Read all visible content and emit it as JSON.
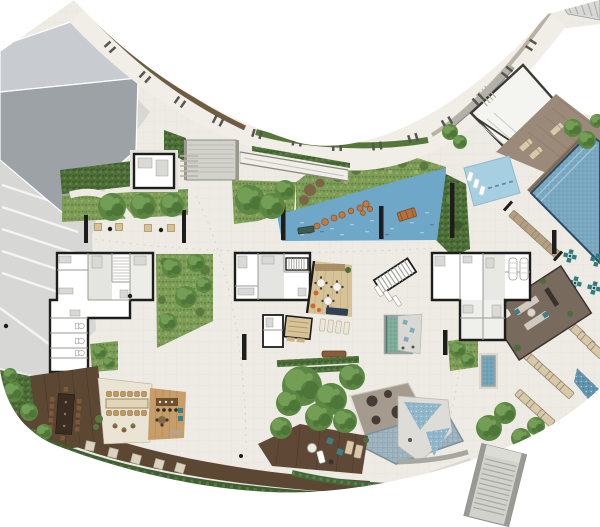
{
  "view": {
    "width": 600,
    "height": 527,
    "background": "#ffffff"
  },
  "plan": {
    "kind-icon": "site-plan-icon",
    "areas": [
      {
        "id": "garage-roof",
        "color_key": "roofMid"
      },
      {
        "id": "parking-court",
        "color_key": "parking"
      },
      {
        "id": "curved-walkway",
        "color_key": "walkway"
      },
      {
        "id": "walkway-hedge-brown",
        "color_key": "hedgeBrown"
      },
      {
        "id": "walkway-hedge-green",
        "color_key": "hedgeGreen"
      },
      {
        "id": "central-lagoon-pond",
        "color_key": "pondBlue"
      },
      {
        "id": "stepping-stones",
        "color_key": "stoneOrange"
      },
      {
        "id": "kids-pool",
        "color_key": "kidsPool"
      },
      {
        "id": "main-pool",
        "color_key": "poolBlue"
      },
      {
        "id": "pool-terrace",
        "color_key": "terrace"
      },
      {
        "id": "northeast-pavilion",
        "color_key": "roofLight"
      },
      {
        "id": "unit-plans-left",
        "color_key": "wall"
      },
      {
        "id": "unit-plans-center",
        "color_key": "wall"
      },
      {
        "id": "unit-plans-right",
        "color_key": "wall"
      },
      {
        "id": "lobby-wood-floor",
        "color_key": "woodFloor"
      },
      {
        "id": "plunge-pool-center",
        "color_key": "plungeGreen"
      },
      {
        "id": "plunge-pool-right",
        "color_key": "plungeBlue"
      },
      {
        "id": "sauna",
        "color_key": "woodFloor"
      },
      {
        "id": "east-lounge-room",
        "color_key": "loungeFloor"
      },
      {
        "id": "mosaic-crosses",
        "color_key": "mosaicTeal"
      },
      {
        "id": "sun-loungers",
        "color_key": "loungerTan"
      },
      {
        "id": "water-channel",
        "color_key": "channelBlue"
      },
      {
        "id": "southwest-wood-deck",
        "color_key": "deckDark"
      },
      {
        "id": "party-room-table",
        "color_key": "chairWood"
      },
      {
        "id": "bar-wood-floor",
        "color_key": "woodMid"
      },
      {
        "id": "south-brown-deck",
        "color_key": "deckBrown"
      },
      {
        "id": "south-taupe-deck",
        "color_key": "deckTaupe"
      },
      {
        "id": "splash-pad",
        "color_key": "splashBlue"
      },
      {
        "id": "south-east-stairs",
        "color_key": "stairGray"
      },
      {
        "id": "gardens-and-trees",
        "color_key": "gardenBase"
      }
    ]
  },
  "palette": {
    "paving": "#edebe3",
    "parking": "#d7d8d6",
    "parkingStripe": "#f4f4f2",
    "roofLight": "#c8ccd0",
    "roofMid": "#9da2a6",
    "walkway": "#f0eee6",
    "hedgeBrown": "#6e5b40",
    "hedgeGreen": "#55773a",
    "curb": "#b9b2a4",
    "wallGray": "#b3b0a9",
    "gardenBase": "#7e9e58",
    "gardenDark": "#617f42",
    "gardenLight": "#95b36e",
    "shrubBrown": "#7a6647",
    "treeBase": "#5c8743",
    "treeHi": "#729e55",
    "treeShadow": "#44672f",
    "pondBlue": "#6ea7c8",
    "pondDash": "#9cc4da",
    "poolBlue": "#79a7c0",
    "poolEdge": "#2e4a63",
    "kidsPool": "#a7cfe2",
    "plungeGreen": "#7dab9b",
    "plungeBlue": "#6fa3b8",
    "splashBlue": "#9db3be",
    "mosaicBlue": "#8fb6c9",
    "mosaicTeal": "#2e7d80",
    "stoneOrange": "#c07a45",
    "benchOrange": "#b5713c",
    "benchTeal": "#3f5a50",
    "deckDark": "#5c4733",
    "deckBrown": "#5f4936",
    "deckTaupe": "#a59a8e",
    "woodFloor": "#d7c398",
    "woodMid": "#c79d69",
    "terrace": "#9b8a79",
    "loungerTan": "#d9c9a8",
    "loungerDark": "#b59f7e",
    "wall": "#1d1d1b",
    "stairGray": "#d2d2cd",
    "stairWall": "#9a9a95",
    "spotDark": "#463c35",
    "tableDark": "#3b2d21",
    "chairWood": "#c09a5e",
    "counterWood": "#6e4f30",
    "navySofa": "#2f3f56",
    "accentOrange": "#cf6a2b",
    "accentTeal": "#3f7e83",
    "loungeFloor": "#796a5e",
    "channelBlue": "#6094ae"
  }
}
